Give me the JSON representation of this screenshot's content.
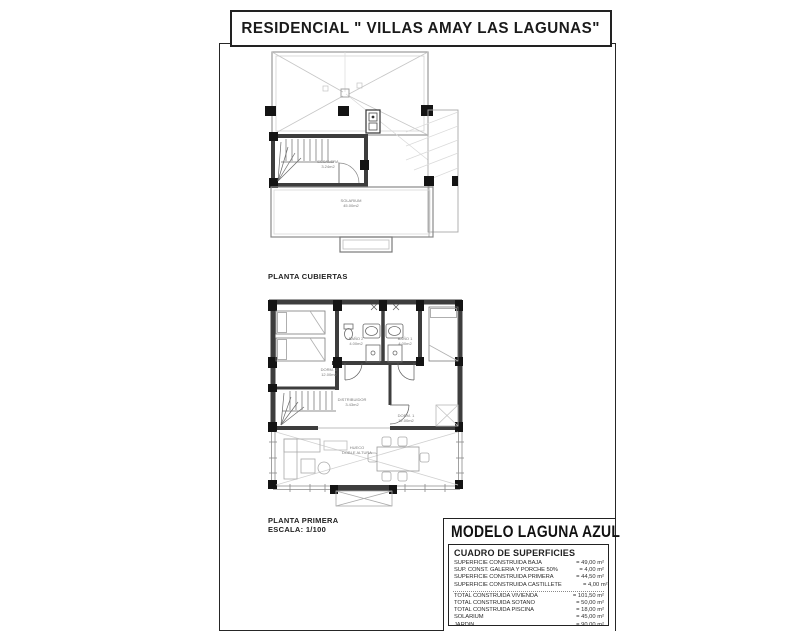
{
  "sheet": {
    "title": "RESIDENCIAL \" VILLAS AMAY LAS LAGUNAS\""
  },
  "roof_plan": {
    "caption": "PLANTA CUBIERTAS",
    "labels": {
      "escalera": {
        "name": "ESCALERA",
        "area": "3.24m2"
      },
      "solarium": {
        "name": "SOLARIUM",
        "area": "45.00m2"
      }
    }
  },
  "first_plan": {
    "caption": "PLANTA PRIMERA",
    "scale": "ESCALA: 1/100",
    "labels": {
      "dorm2": {
        "name": "DORM. 2",
        "area": "12.00m2"
      },
      "bano2": {
        "name": "BAÑO 2",
        "area": "4.00m2"
      },
      "bano1": {
        "name": "BAÑO 1",
        "area": "4.00m2"
      },
      "dorm1": {
        "name": "DORM. 1",
        "area": "12.00m2"
      },
      "distribuidor": {
        "name": "DISTRIBUIDOR",
        "area": "3.43m2"
      },
      "hueco": {
        "name": "HUECO",
        "area": "DOBLE ALTURA"
      }
    }
  },
  "model_panel": {
    "title": "MODELO LAGUNA AZUL",
    "table_header": "CUADRO DE SUPERFICIES",
    "rows1": [
      {
        "label": "SUPERFICIE CONSTRUIDA BAJA",
        "value": "= 49,00 m²"
      },
      {
        "label": "SUP. CONST. GALERIA Y PORCHE 50%",
        "value": "= 4,00 m²"
      },
      {
        "label": "SUPERFICIE CONSTRUIDA PRIMERA",
        "value": "= 44,50 m²"
      },
      {
        "label": "SUPERFICIE CONSTRUIDA CASTILLETE",
        "value": "= 4,00 m²"
      }
    ],
    "rows2": [
      {
        "label": "TOTAL CONSTRUIDA VIVIENDA",
        "value": "= 101,50 m²"
      },
      {
        "label": "TOTAL CONSTRUIDA SOTANO",
        "value": "= 50,00 m²"
      },
      {
        "label": "TOTAL CONSTRUIDA PISCINA",
        "value": "= 18,00 m²"
      },
      {
        "label": "SOLARIUM",
        "value": "= 45,00 m²"
      },
      {
        "label": "JARDIN",
        "value": "= 90,00 m²"
      }
    ]
  },
  "colors": {
    "ink": "#1a1a1a",
    "wall": "#3d3d3d",
    "light_line": "#b5b5b5"
  }
}
